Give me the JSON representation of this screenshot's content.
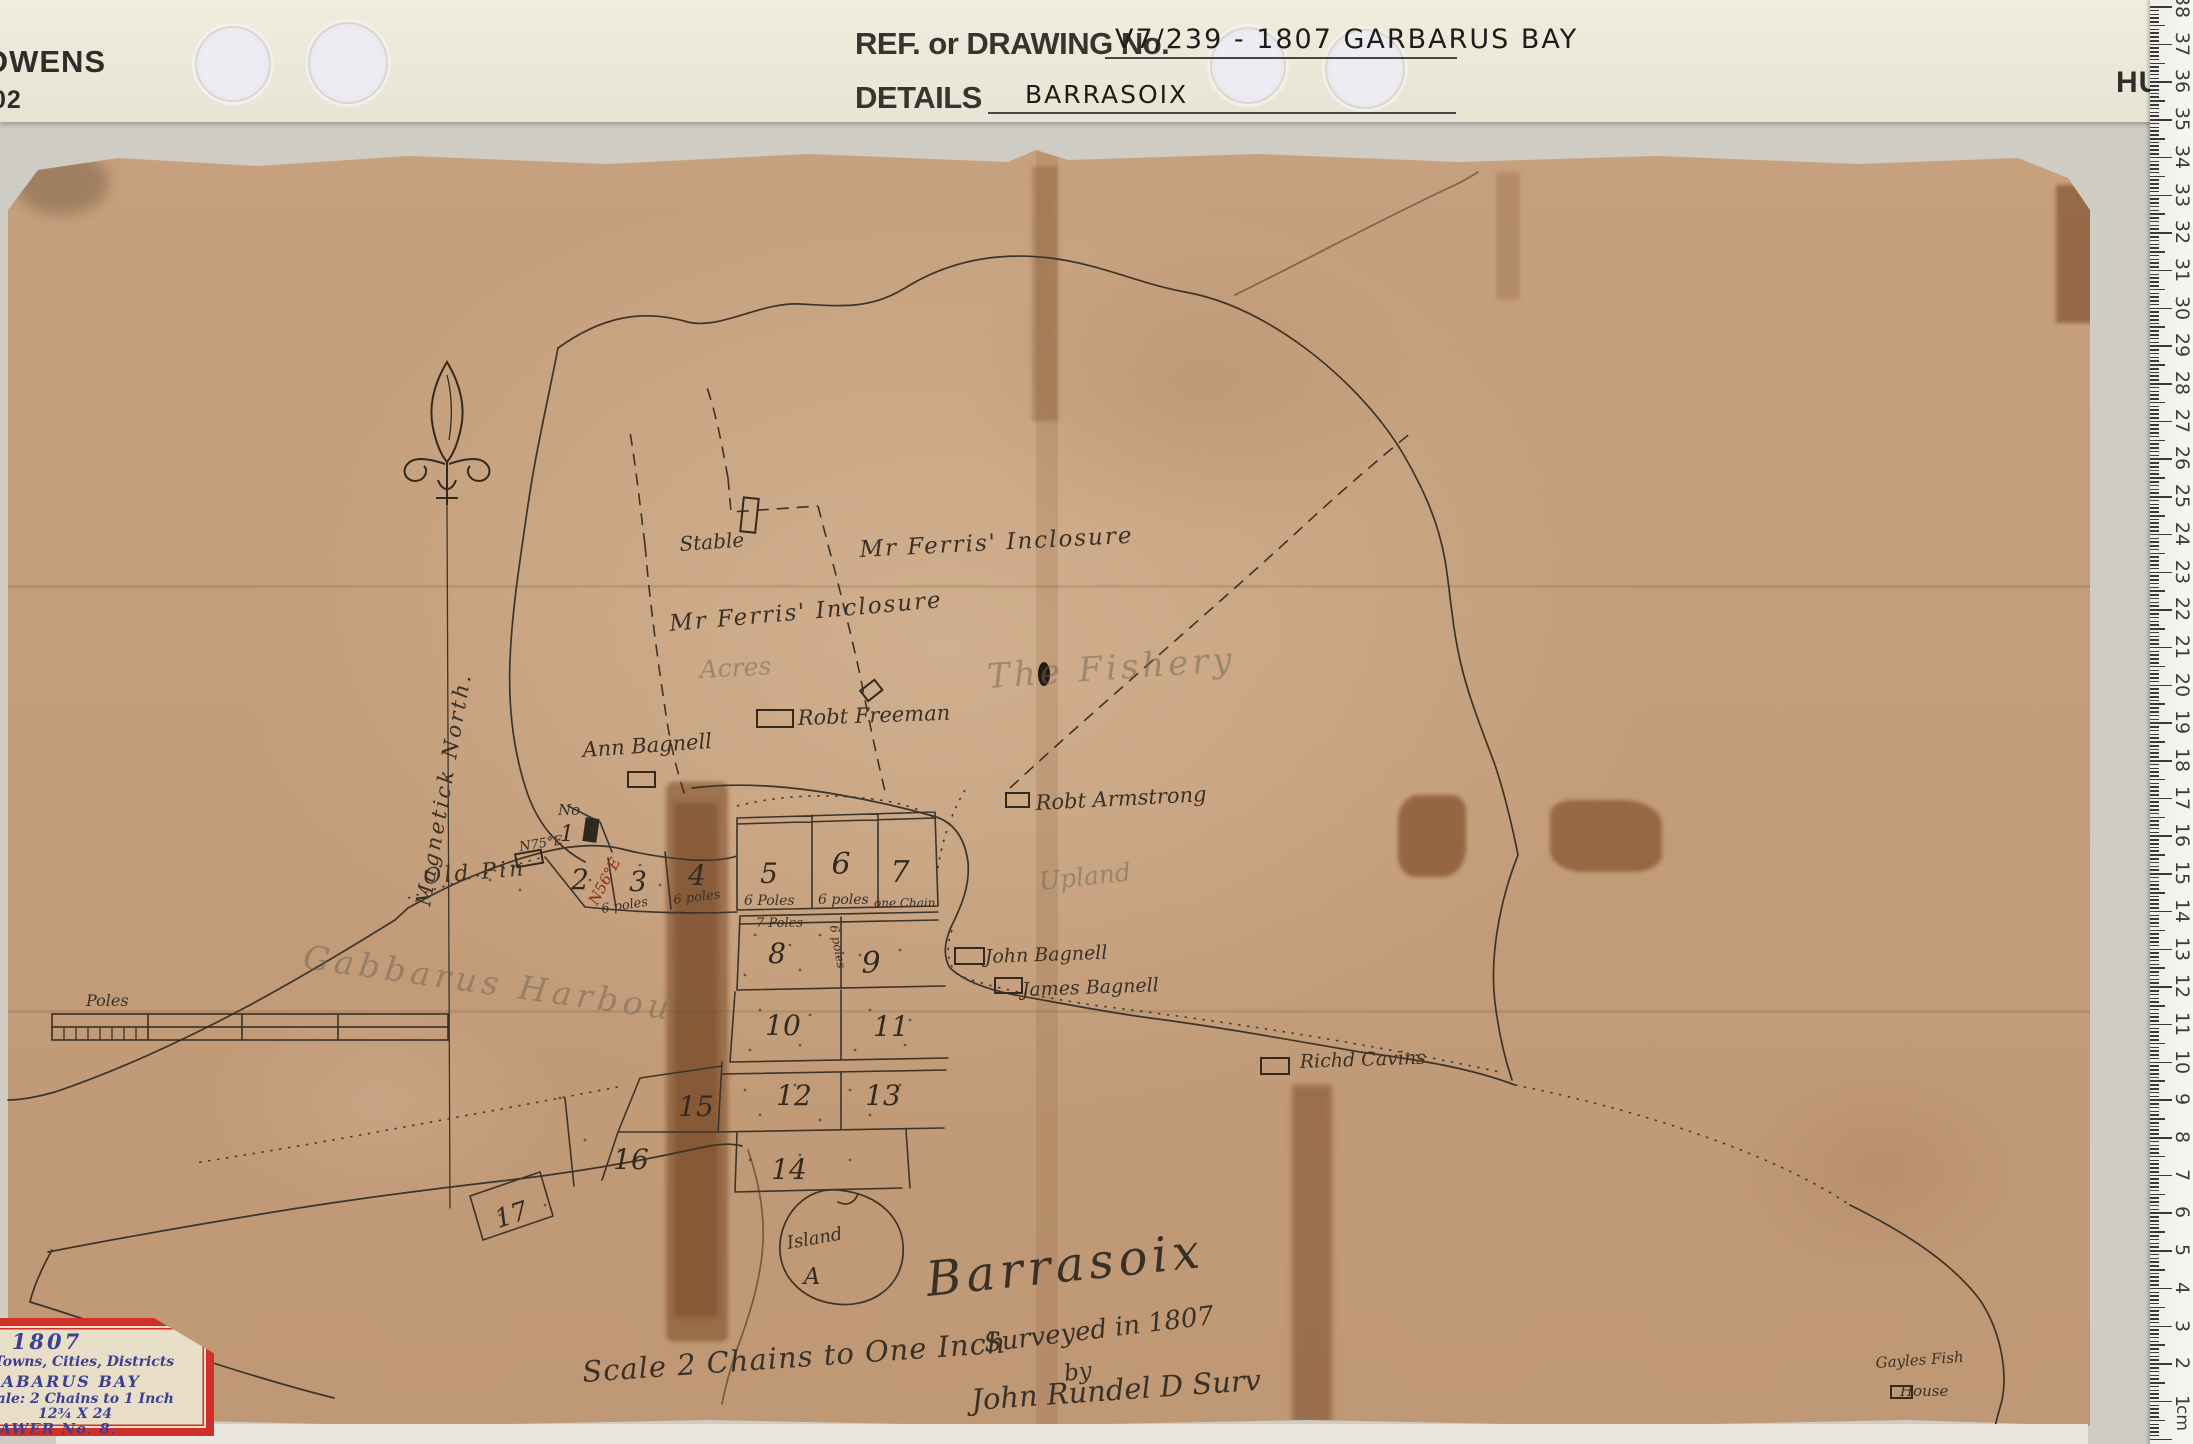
{
  "header": {
    "brand_left": "OWENS",
    "brand_left_num": "02",
    "brand_right": "HU",
    "ref_label": "REF. or DRAWING No.",
    "ref_value": "V7/239 - 1807 GARBARUS BAY",
    "details_label": "DETAILS",
    "details_value": "BARRASOIX"
  },
  "archival_label": {
    "year": "1807",
    "line1": "Towns, Cities, Districts",
    "line2": "GABARUS BAY",
    "line3": "Scale: 2 Chains to 1 Inch",
    "line4": "12¾ X 24",
    "line5": "DRAWER No. 8."
  },
  "ruler": {
    "unit": "cm",
    "numbers": [
      "38",
      "37",
      "36",
      "35",
      "34",
      "33",
      "32",
      "31",
      "30",
      "29",
      "28",
      "27",
      "26",
      "25",
      "24",
      "23",
      "22",
      "21",
      "20",
      "19",
      "18",
      "17",
      "16",
      "15",
      "14",
      "13",
      "12",
      "11",
      "10",
      "9",
      "8",
      "7",
      "6",
      "5",
      "4",
      "3",
      "2",
      "1"
    ]
  },
  "map": {
    "title": "Barrasoix",
    "scale_note": "Scale 2 Chains to One Inch",
    "surveyed": {
      "l1": "Surveyed in 1807",
      "l2": "by",
      "l3": "John Rundel D Surv"
    },
    "north_label": "Magnetick North.",
    "scale_bar_label": "Poles",
    "island": {
      "word": "Island",
      "letter": "A"
    },
    "no_label": {
      "prefix": "No",
      "value": "1"
    },
    "bearing_black": "N75°E",
    "bearing_red": "N56°E",
    "lot_numbers": [
      "2",
      "3",
      "4",
      "5",
      "6",
      "7",
      "8",
      "9",
      "10",
      "11",
      "12",
      "13",
      "14",
      "15",
      "16",
      "17"
    ],
    "measurements": {
      "m3": "6 poles",
      "m4": "6 poles",
      "m5": "6 Poles",
      "m6": "6 poles",
      "m7": "one Chain",
      "m8": "7 Poles",
      "m89": "6 poles"
    },
    "owners": {
      "stable": "Stable",
      "ferris_upper": "Mr Ferris' Inclosure",
      "ferris_lower": "Mr Ferris' Inclosure",
      "freeman": "Robt Freeman",
      "ann_bagnell": "Ann Bagnell",
      "armstrong": "Robt Armstrong",
      "john_bagnell": "John Bagnell",
      "james_bagnell": "James Bagnell",
      "cavins": "Richd Cavins",
      "old_pin": "Old Pin",
      "gayles1": "Gayles Fish",
      "gayles2": "House"
    },
    "pencil": {
      "acres": "Acres",
      "fishery": "The Fishery",
      "upland": "Upland",
      "harbour": "Gabbarus Harbour"
    }
  },
  "colors": {
    "map_paper": "#c6a07d",
    "header_paper": "#ece8da",
    "label_red": "#cf3128",
    "label_ink": "#3d3f93",
    "map_ink": "#3d3429",
    "stain_brown": "#8a5a33",
    "ruler_white": "#f5f4f0"
  }
}
